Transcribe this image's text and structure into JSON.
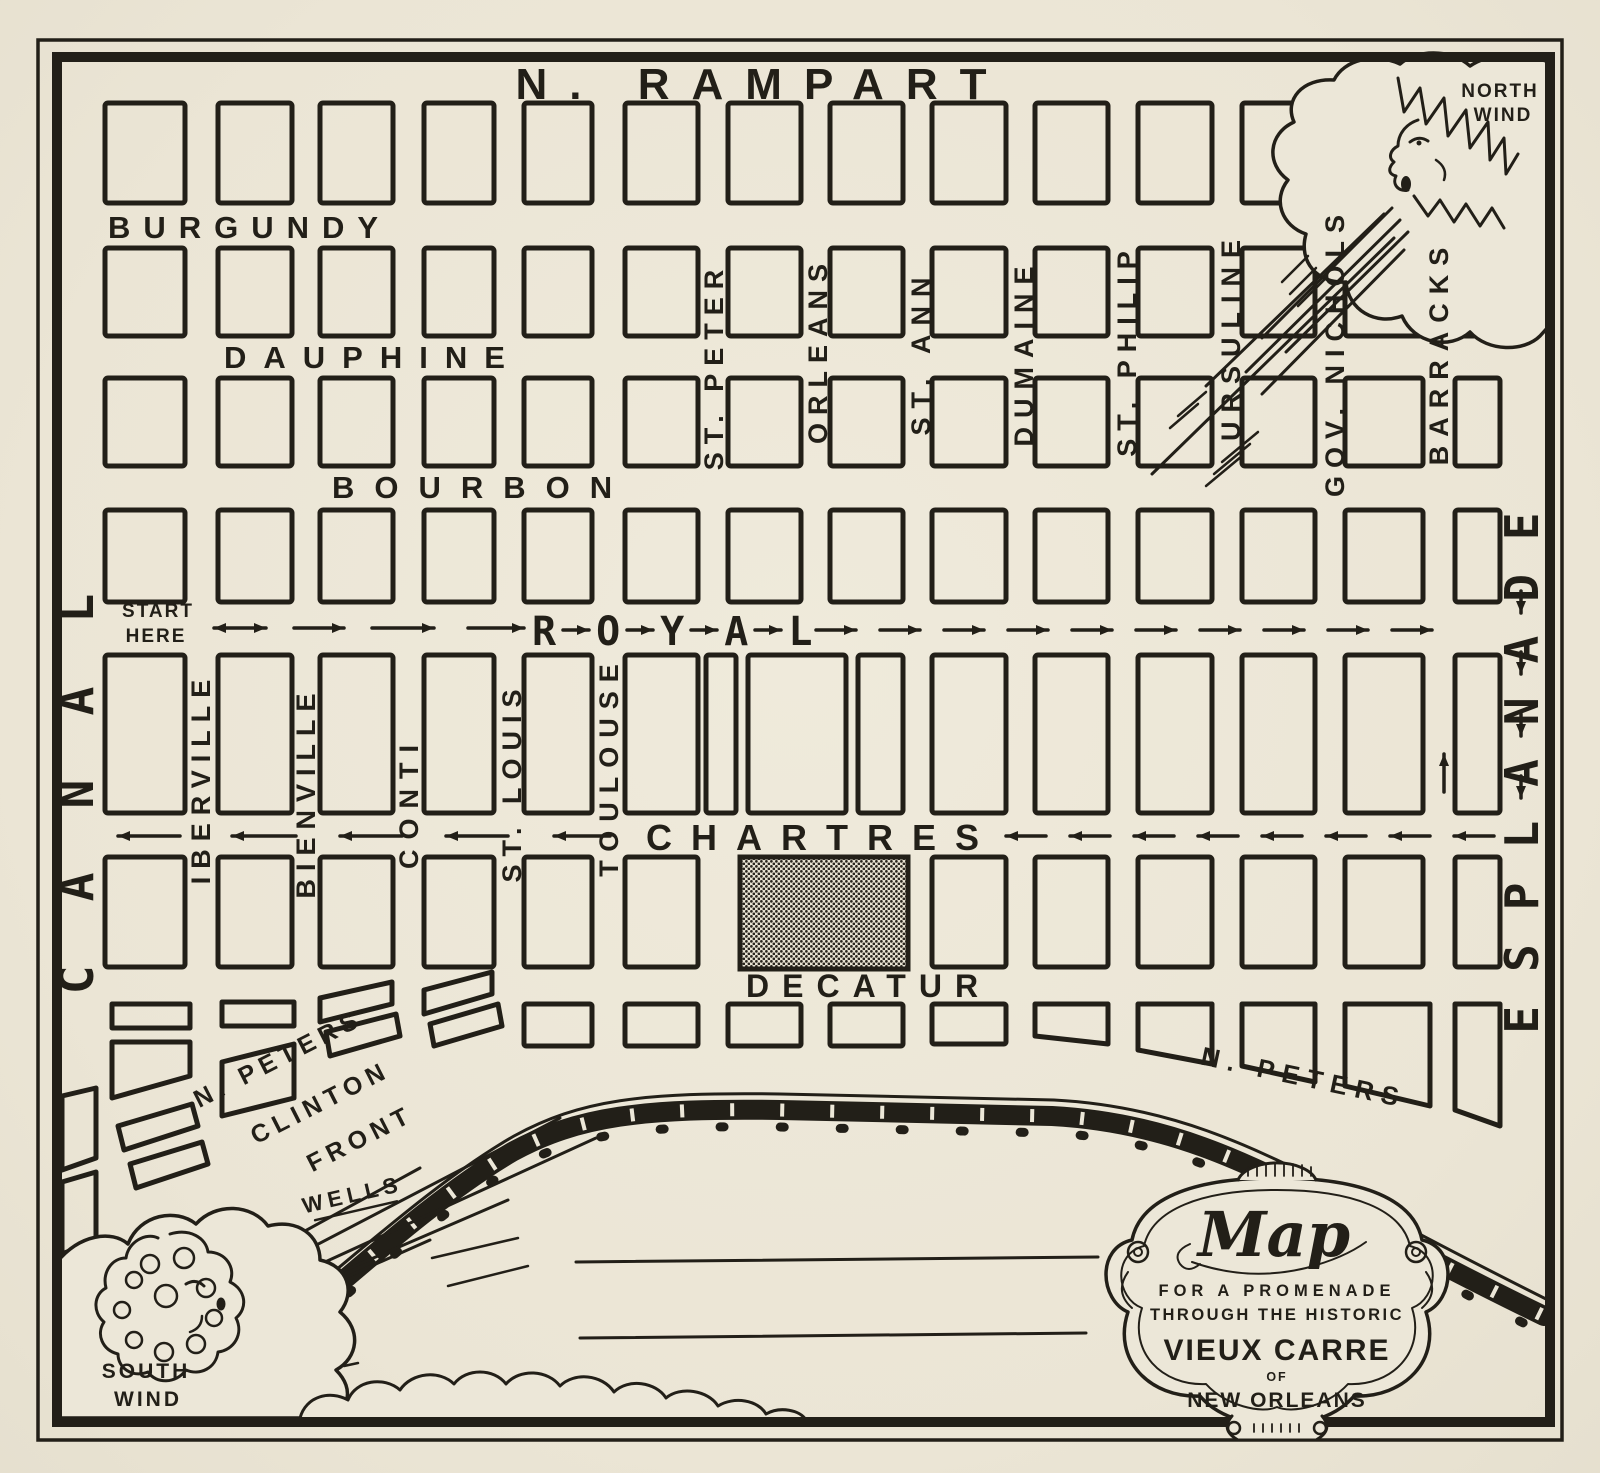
{
  "colors": {
    "paper": "#ece7d8",
    "ink": "#221f18"
  },
  "streets": {
    "rampart": "N. RAMPART",
    "burgundy": "BURGUNDY",
    "dauphine": "DAUPHINE",
    "bourbon": "BOURBON",
    "royal": "ROYAL",
    "chartres": "CHARTRES",
    "decatur": "DECATUR",
    "canal": "CANAL",
    "iberville": "IBERVILLE",
    "bienville": "BIENVILLE",
    "conti": "CONTI",
    "stlouis": "ST. LOUIS",
    "toulouse": "TOULOUSE",
    "stpeter": "ST. PETER",
    "orleans": "ORLEANS",
    "stann": "ST. ANN",
    "dumaine": "DUMAINE",
    "stphilip": "ST. PHILIP",
    "ursuline": "URSULINE",
    "govnichols": "GOV. NICHOLS",
    "barracks": "BARRACKS",
    "esplanade": "ESPLANADE",
    "npeters_left": "N. PETERS",
    "clinton": "CLINTON",
    "front": "FRONT",
    "wells": "WELLS",
    "npeters_right": "N. PETERS"
  },
  "route": {
    "start_line1": "START",
    "start_line2": "HERE"
  },
  "winds": {
    "north_line1": "NORTH",
    "north_line2": "WIND",
    "south_line1": "SOUTH",
    "south_line2": "WIND"
  },
  "cartouche": {
    "script_title": "Map",
    "line1": "FOR A PROMENADE",
    "line2": "THROUGH THE HISTORIC",
    "line3": "VIEUX CARRE",
    "line4": "OF",
    "line5": "NEW ORLEANS"
  }
}
